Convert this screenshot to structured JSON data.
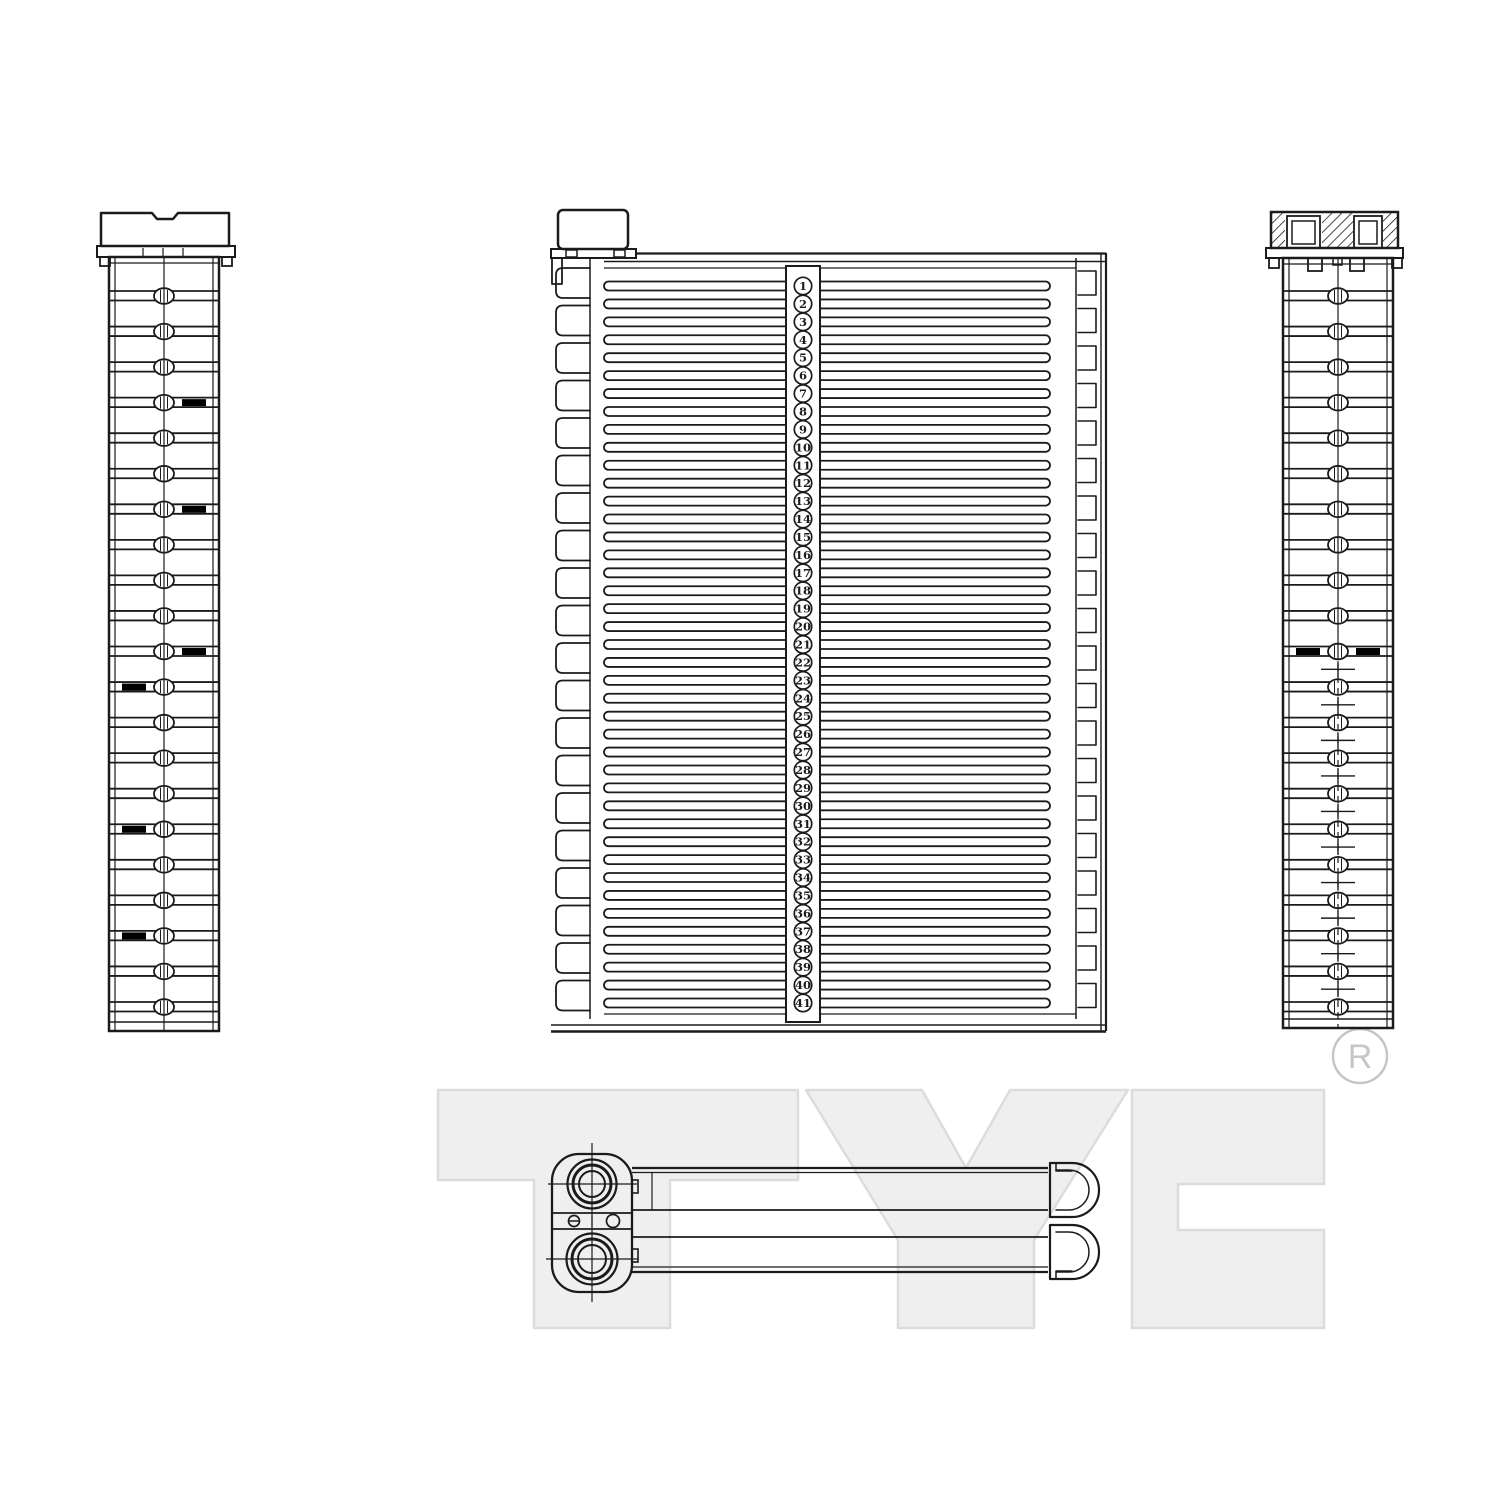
{
  "colors": {
    "background": "#ffffff",
    "line": "#1b1b1b",
    "mark": "#000000",
    "watermark_fill": "#efefef",
    "watermark_stroke": "#dcdcdc",
    "registered": "#c6c6c6"
  },
  "watermark": {
    "text": "TYC",
    "registered_letter": "R"
  },
  "front_view": {
    "tube_count": 41,
    "tube_labels": [
      "1",
      "2",
      "3",
      "4",
      "5",
      "6",
      "7",
      "8",
      "9",
      "10",
      "11",
      "12",
      "13",
      "14",
      "15",
      "16",
      "17",
      "18",
      "19",
      "20",
      "21",
      "22",
      "23",
      "24",
      "25",
      "26",
      "27",
      "28",
      "29",
      "30",
      "31",
      "32",
      "33",
      "34",
      "35",
      "36",
      "37",
      "38",
      "39",
      "40",
      "41"
    ]
  },
  "left_side_view": {
    "rung_count": 21,
    "alignment_marks": [
      {
        "rung": 4,
        "side": "right"
      },
      {
        "rung": 7,
        "side": "right"
      },
      {
        "rung": 11,
        "side": "right"
      },
      {
        "rung": 12,
        "side": "left"
      },
      {
        "rung": 16,
        "side": "left"
      },
      {
        "rung": 19,
        "side": "left"
      }
    ]
  },
  "right_side_view": {
    "rung_count": 21,
    "alignment_marks": [
      {
        "rung": 11,
        "side": "left"
      },
      {
        "rung": 11,
        "side": "right"
      }
    ],
    "cross_mark_count": 10,
    "cross_marks_start_after_rung": 11
  }
}
